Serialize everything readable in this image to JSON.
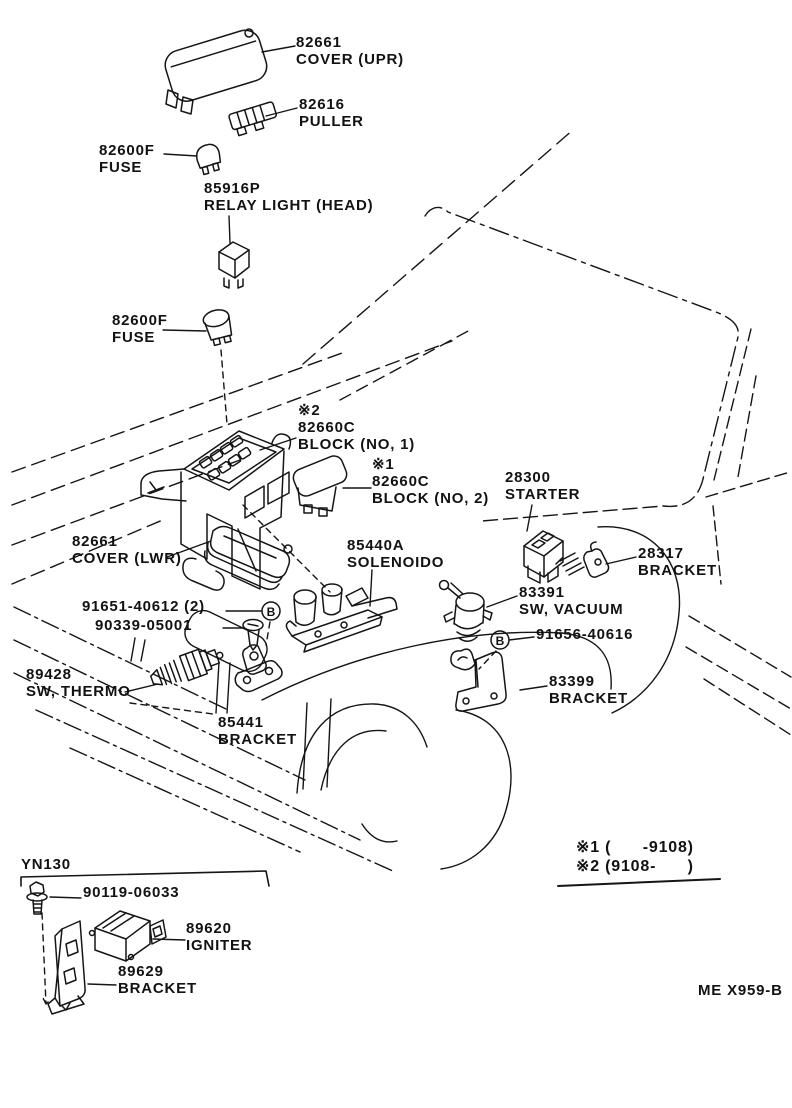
{
  "diagram": {
    "page_code": "ME X959-B",
    "model_code": "YN130",
    "marker_b": "B",
    "notes": [
      "※1 (      -9108)",
      "※2 (9108-      )"
    ],
    "labels": [
      {
        "id": "cover-upr",
        "x": 296,
        "y": 34,
        "lines": [
          "82661",
          "COVER (UPR)"
        ]
      },
      {
        "id": "puller",
        "x": 299,
        "y": 96,
        "lines": [
          "82616",
          "PULLER"
        ]
      },
      {
        "id": "fuse-upper",
        "x": 99,
        "y": 142,
        "lines": [
          "82600F",
          "FUSE"
        ]
      },
      {
        "id": "relay-light-head",
        "x": 204,
        "y": 180,
        "lines": [
          "85916P",
          "RELAY LIGHT (HEAD)"
        ]
      },
      {
        "id": "fuse-lower",
        "x": 112,
        "y": 312,
        "lines": [
          "82600F",
          "FUSE"
        ]
      },
      {
        "id": "block-no-1",
        "x": 298,
        "y": 402,
        "lines": [
          "※2",
          "82660C",
          "BLOCK (NO, 1)"
        ]
      },
      {
        "id": "block-no-2",
        "x": 372,
        "y": 456,
        "lines": [
          "※1",
          "82660C",
          "BLOCK (NO, 2)"
        ]
      },
      {
        "id": "starter",
        "x": 505,
        "y": 469,
        "lines": [
          "28300",
          "STARTER"
        ]
      },
      {
        "id": "cover-lwr",
        "x": 72,
        "y": 533,
        "lines": [
          "82661",
          "COVER (LWR)"
        ]
      },
      {
        "id": "solenoid",
        "x": 347,
        "y": 537,
        "lines": [
          "85440A",
          "SOLENOIDO"
        ]
      },
      {
        "id": "bracket-28317",
        "x": 638,
        "y": 545,
        "lines": [
          "28317",
          "BRACKET"
        ]
      },
      {
        "id": "bolt-91651",
        "x": 82,
        "y": 598,
        "lines": [
          "91651-40612 (2)"
        ]
      },
      {
        "id": "screw-90339",
        "x": 95,
        "y": 617,
        "lines": [
          "90339-05001"
        ]
      },
      {
        "id": "sw-vacuum",
        "x": 519,
        "y": 584,
        "lines": [
          "83391",
          "SW, VACUUM"
        ]
      },
      {
        "id": "bolt-91656",
        "x": 536,
        "y": 626,
        "lines": [
          "91656-40616"
        ]
      },
      {
        "id": "sw-thermo",
        "x": 26,
        "y": 666,
        "lines": [
          "89428",
          "SW, THERMO"
        ]
      },
      {
        "id": "bracket-83399",
        "x": 549,
        "y": 673,
        "lines": [
          "83399",
          "BRACKET"
        ]
      },
      {
        "id": "bracket-85441",
        "x": 218,
        "y": 714,
        "lines": [
          "85441",
          "BRACKET"
        ]
      },
      {
        "id": "model-code",
        "x": 21,
        "y": 856,
        "lines": [
          "YN130"
        ]
      },
      {
        "id": "bolt-90119",
        "x": 83,
        "y": 884,
        "lines": [
          "90119-06033"
        ]
      },
      {
        "id": "igniter",
        "x": 186,
        "y": 920,
        "lines": [
          "89620",
          "IGNITER"
        ]
      },
      {
        "id": "bracket-89629",
        "x": 118,
        "y": 963,
        "lines": [
          "89629",
          "BRACKET"
        ]
      },
      {
        "id": "note-1",
        "x": 576,
        "y": 839,
        "lines": [
          "※1 (      -9108)"
        ]
      },
      {
        "id": "note-2",
        "x": 576,
        "y": 858,
        "lines": [
          "※2 (9108-      )"
        ]
      },
      {
        "id": "page-code",
        "x": 698,
        "y": 982,
        "lines": [
          "ME X959-B"
        ]
      }
    ]
  }
}
